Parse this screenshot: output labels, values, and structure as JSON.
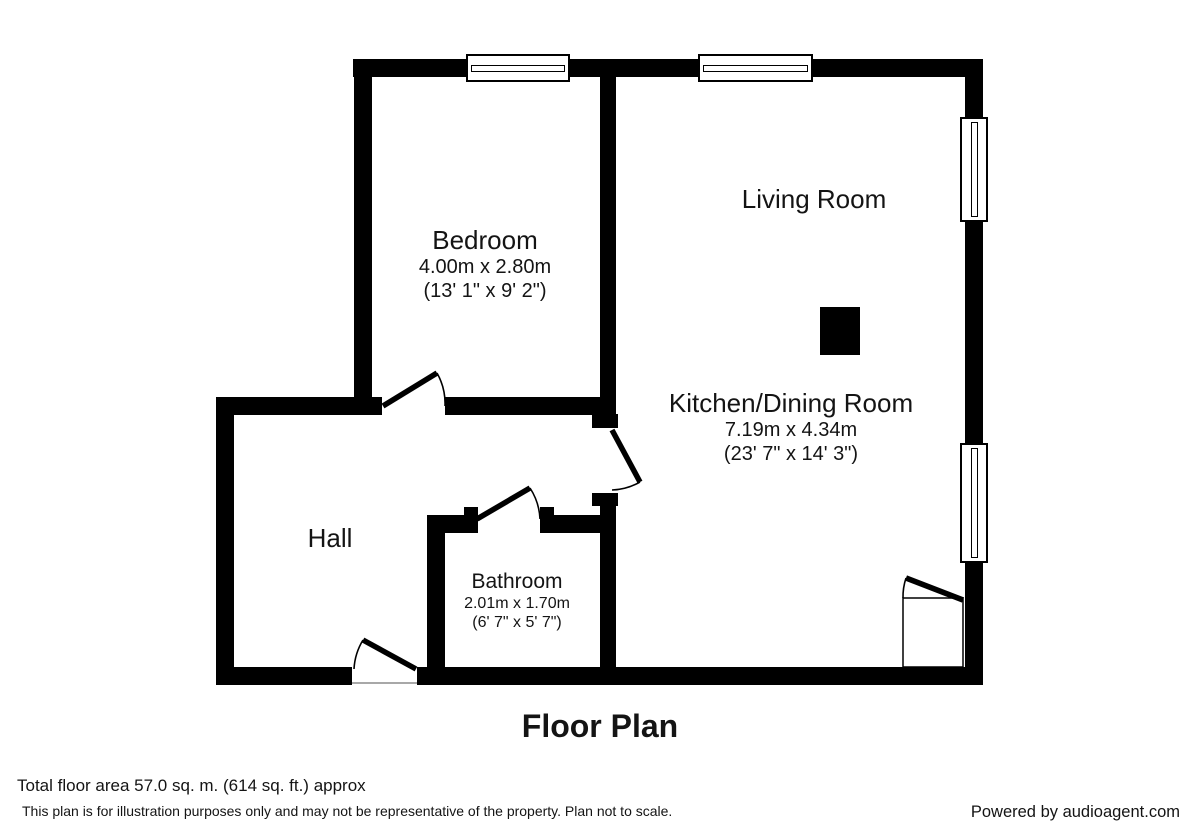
{
  "plan": {
    "title": "Floor Plan",
    "rooms": [
      {
        "id": "bedroom",
        "name": "Bedroom",
        "dims_metric": "4.00m x 2.80m",
        "dims_imperial": "(13' 1\" x 9' 2\")"
      },
      {
        "id": "living-room",
        "name": "Living Room",
        "dims_metric": "",
        "dims_imperial": ""
      },
      {
        "id": "kitchen-dining",
        "name": "Kitchen/Dining Room",
        "dims_metric": "7.19m x 4.34m",
        "dims_imperial": "(23' 7\" x 14' 3\")"
      },
      {
        "id": "hall",
        "name": "Hall",
        "dims_metric": "",
        "dims_imperial": ""
      },
      {
        "id": "bathroom",
        "name": "Bathroom",
        "dims_metric": "2.01m x 1.70m",
        "dims_imperial": "(6' 7\" x 5' 7\")"
      }
    ]
  },
  "footer": {
    "total_area": "Total floor area 57.0 sq. m. (614 sq. ft.) approx",
    "disclaimer": "This plan is for illustration purposes only and may not be representative of the property. Plan not to scale.",
    "credit": "Powered by audioagent.com"
  },
  "colors": {
    "wall": "#000000",
    "background": "#ffffff",
    "text": "#141414"
  }
}
